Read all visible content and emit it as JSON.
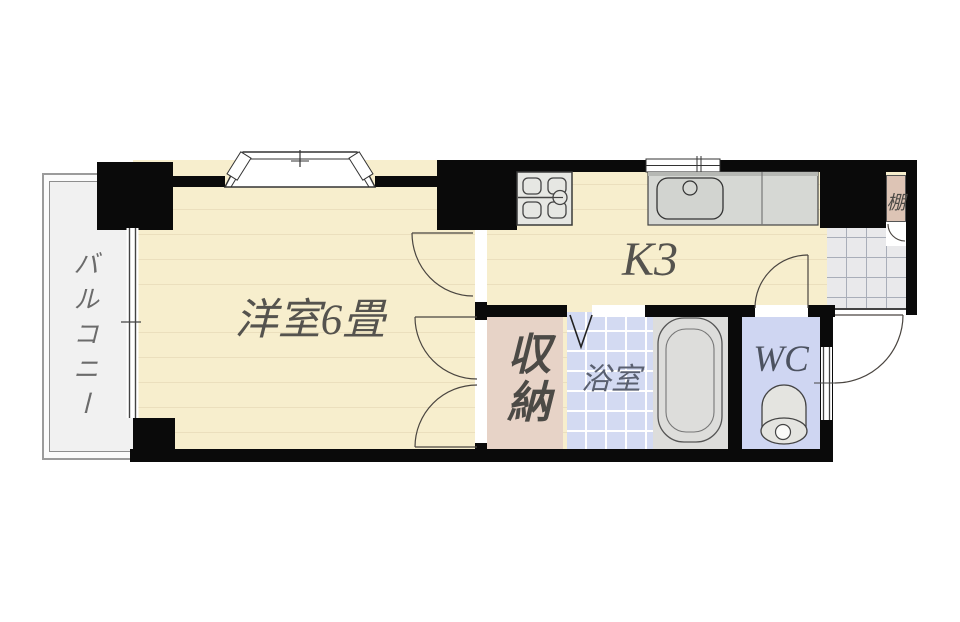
{
  "plan_title": "1K apartment floor plan",
  "rooms": {
    "balcony": {
      "label": "バルコニー"
    },
    "western_room": {
      "label": "洋室6畳"
    },
    "kitchen": {
      "label": "K3"
    },
    "storage": {
      "label": "収納"
    },
    "bathroom": {
      "label": "浴室"
    },
    "wc": {
      "label": "WC"
    },
    "shelf": {
      "label": "棚"
    }
  },
  "fixtures": [
    "bay-window",
    "balcony-sliding-window",
    "stove",
    "kitchen-sink",
    "kitchen-window",
    "bathtub",
    "folding-door",
    "toilet",
    "wc-window",
    "entrance-tiles",
    "entrance-door",
    "shelf-door",
    "room-door",
    "closet-double-doors"
  ],
  "colors": {
    "wall": "#0a0a0a",
    "floor": "#f7eecd",
    "floorline": "#ebdfbd",
    "bath": "#d3daf2",
    "wc": "#cfd6f2",
    "tile": "#e9e9eb",
    "tileline": "#a9aeb9",
    "storage": "#e7d3c7",
    "shelf": "#ddc4b5",
    "balcony": "#f1f1f1",
    "fixture": "#e6e7e3",
    "counter": "#d6d8d4",
    "text": "#55534e",
    "line": "#4a4540"
  }
}
